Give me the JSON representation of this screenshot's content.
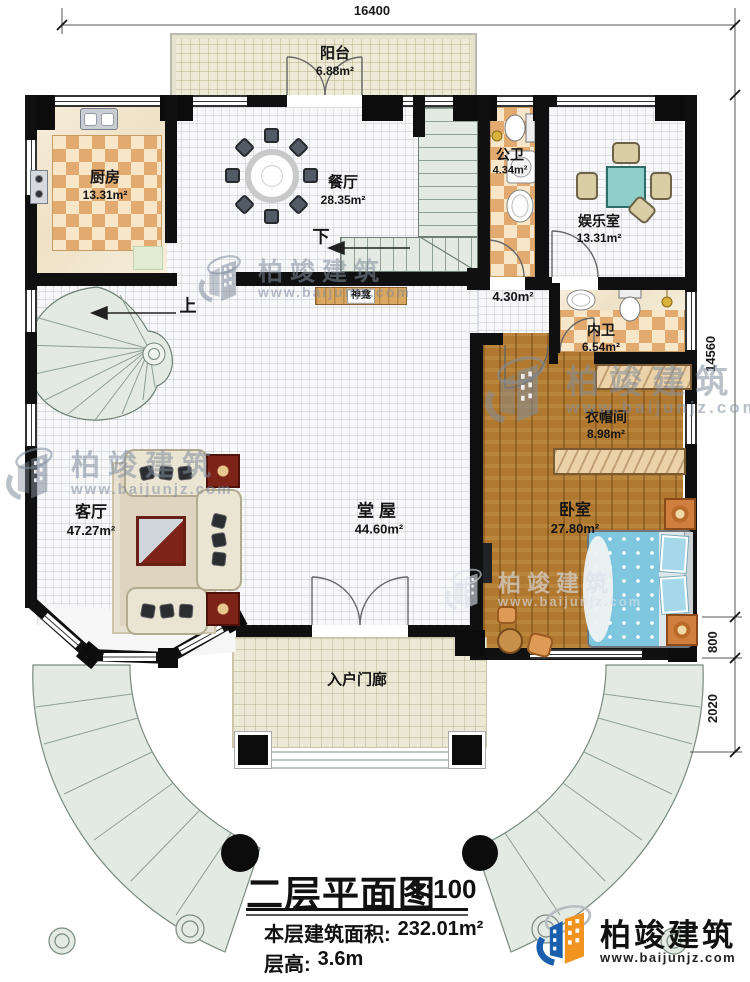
{
  "dimensions": {
    "top": "16400",
    "right_main": "14560",
    "right_step": "800",
    "right_porch": "2020"
  },
  "rooms": {
    "balcony": {
      "name": "阳台",
      "area": "6.88m²"
    },
    "kitchen": {
      "name": "厨房",
      "area": "13.31m²"
    },
    "dining": {
      "name": "餐厅",
      "area": "28.35m²"
    },
    "public_bath": {
      "name": "公卫",
      "area": "4.34m²"
    },
    "entertainment": {
      "name": "娱乐室",
      "area": "13.31m²"
    },
    "corridor": {
      "area": "4.30m²"
    },
    "ensuite_bath": {
      "name": "内卫",
      "area": "6.54m²"
    },
    "cloakroom": {
      "name": "衣帽间",
      "area": "8.98m²"
    },
    "bedroom": {
      "name": "卧室",
      "area": "27.80m²"
    },
    "hall": {
      "name": "堂屋",
      "area": "44.60m²"
    },
    "living": {
      "name": "客厅",
      "area": "47.27m²"
    },
    "porch": {
      "name": "入户门廊"
    }
  },
  "annotations": {
    "shrine": "神龛",
    "stairs_up": "上",
    "stairs_down": "下"
  },
  "title_block": {
    "title": "二层平面图",
    "scale": "1:100",
    "floor_area_label": "本层建筑面积:",
    "floor_area_value": "232.01m²",
    "floor_height_label": "层高:",
    "floor_height_value": "3.6m"
  },
  "brand": {
    "name": "柏竣建筑",
    "website": "www.baijunjz.com"
  },
  "colors": {
    "wall": "#101010",
    "checker_dark": "#e3aa70",
    "checker_light": "#f7e7c8",
    "wood": "#b1792f",
    "stair": "#e2eae3",
    "brand_blue": "#1a5fae",
    "brand_orange": "#f0941f"
  }
}
